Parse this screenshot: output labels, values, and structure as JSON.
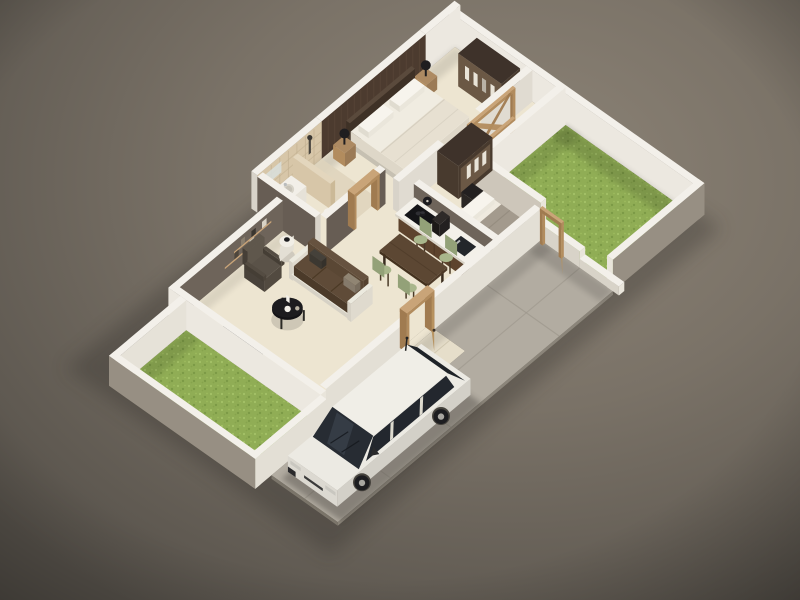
{
  "image_type": "isometric-3d-floor-plan-render",
  "palette": {
    "bg_light": "#8d8477",
    "bg_mid": "#7a7267",
    "bg_dark": "#56514a",
    "vignette": "#000000",
    "shadow": "#332f29",
    "wall_top": "#f3f0ea",
    "wall_inner_white": "#ece8e0",
    "wall_inner_white2": "#e6e2d8",
    "wall_cap": "#d8d3c9",
    "wall_cap_bright": "#e9e5db",
    "wall_mid": "#a29a8e",
    "wall_outer": "#978f83",
    "wall_front_bright": "#e3dfd5",
    "wall_grey_warm": "#6e645a",
    "wall_grey_dark": "#675d54",
    "wall_grey_inner": "#e0dbd1",
    "wall_behind_bed2": "#cdc6ba",
    "accent_dark": "#4c3b2f",
    "accent_line": "#5d4a3b",
    "bath_tile": "#d7c6a8",
    "bath_tile2": "#cbb997",
    "bath_tile_top": "#e3d6bd",
    "bath_grout": "#bfae8e",
    "bath_floor": "#ded4bc",
    "floor_beige": "#ede5d1",
    "grass_base": "#90ad55",
    "grass_light": "#a4c167",
    "grass_light2": "#9cba5e",
    "grass_dark": "#7c9a46",
    "grass_dark2": "#86a44d",
    "walk_tile": "#e6deca",
    "walk_joint": "#c9c0a8",
    "concrete": "#b2aca1",
    "concrete_joint": "#9c968b",
    "slab_edge": "#8b857a",
    "slab_edge2": "#7d776c",
    "wood_light": "#c9a478",
    "wood_light_sh": "#b28c5e",
    "wood_mid": "#a07b50",
    "wood_leaf": "#b7935f",
    "ward_dark": "#483a2e",
    "ward_dark_top": "#3e322a",
    "ward_inner": "#6b5845",
    "cloth_white": "#e9e4d8",
    "cloth_grey": "#b9b2a6",
    "bed_white": "#f0ece1",
    "bed_side": "#ded7c8",
    "bed_base": "#cbc4b5",
    "pillow_white": "#f7f4ed",
    "duvet": "#e7e0d1",
    "headboard": "#3e3126",
    "bed2_blanket": "#a39a8d",
    "bed2_blanket2": "#b1a89b",
    "nstand_wood": "#9b7a55",
    "nstand_top": "#ad8a62",
    "lamp_black": "#1f1e20",
    "sofa_top": "#5f4b38",
    "sofa_se": "#55422f",
    "sofa_sw": "#4b3a29",
    "sofa_back": "#66523f",
    "sofa_back2": "#5a4734",
    "sofa_frame": "#eceadf",
    "sofa_frame2": "#dfdace",
    "pillow_dark": "#3c3831",
    "pillow_taupe": "#857a6b",
    "chair_seat": "#a9b68b",
    "chair_back": "#93a178",
    "chair_leg": "#4a3a28",
    "table_top": "#5c4733",
    "table_se": "#4e3a28",
    "table_sw": "#44321f",
    "counter_wood": "#6e5138",
    "counter_wood_dk": "#5d432d",
    "counter_top": "#f3f0e9",
    "counter_top_se": "#e5e1d7",
    "counter_top_sw": "#d9d4c8",
    "cooktop": "#141417",
    "burner": "#2e2e33",
    "sink_dark": "#23262a",
    "steel": "#b9bcbd",
    "appliance": "#232020",
    "clock_black": "#1d1c1f",
    "tv_black": "#0f0f13",
    "table_black": "#1d1c1f",
    "table_black2": "#141316",
    "candle": "#f2efe8",
    "arm_top": "#5a5248",
    "arm_se": "#524a40",
    "arm_sw": "#49423a",
    "arm_back": "#5f574c",
    "arm_back_sw": "#463f37",
    "side_top": "#f1eee6",
    "side_side": "#e3dfd4",
    "side_base": "#cfcabe",
    "decor_black": "#1b1b1e",
    "wc_white": "#f4f1ea",
    "wc_se": "#e8e4da",
    "wc_sw": "#ded9cd",
    "basin": "#d7d3c8",
    "basin2": "#c7c3b8",
    "fixture_dark": "#4a463f",
    "mirror": "#d9ded9",
    "glass": "#272c33",
    "glass_dark": "#1e2227",
    "glass_light": "#3d4550",
    "car_top": "#eceae3",
    "car_side": "#d3d0c8",
    "car_front": "#dcd9d1",
    "car_detail": "#c9c7c0",
    "tire": "#1d1d20",
    "hub": "#a8a6a0",
    "arch": "#46433d",
    "car_dark": "#2a2a2c",
    "grill": "#3a3a3a",
    "book1": "#d8d2c4",
    "book2": "#3a362f",
    "book3": "#8a7f6e",
    "book4": "#c9c2b2",
    "book5": "#4e463c"
  },
  "scene": {
    "view": "isometric-3d-floorplan",
    "rooms": [
      {
        "name": "master-bedroom"
      },
      {
        "name": "bathroom"
      },
      {
        "name": "second-bedroom"
      },
      {
        "name": "living-room"
      },
      {
        "name": "kitchen-dining"
      },
      {
        "name": "entrance-walkway"
      },
      {
        "name": "front-yard-grass"
      },
      {
        "name": "back-yard-grass"
      },
      {
        "name": "driveway"
      }
    ],
    "furniture": [
      "double-bed",
      "bedside-lamps",
      "master-wardrobe",
      "second-wardrobe",
      "single-bed",
      "kitchen-counter",
      "cooktop",
      "kitchen-sink",
      "dining-table",
      "dining-chairs",
      "sofa",
      "armchair",
      "coffee-table",
      "side-table",
      "tv-panel",
      "wall-shelf",
      "shower",
      "bathroom-sink",
      "toilet",
      "wood-door-frames"
    ],
    "counts": {
      "beds": 2,
      "dining_chairs": 4,
      "yards": 2,
      "bedside_lamps": 2
    },
    "vehicle": {
      "type": "hatchback-car",
      "color": "white"
    }
  }
}
